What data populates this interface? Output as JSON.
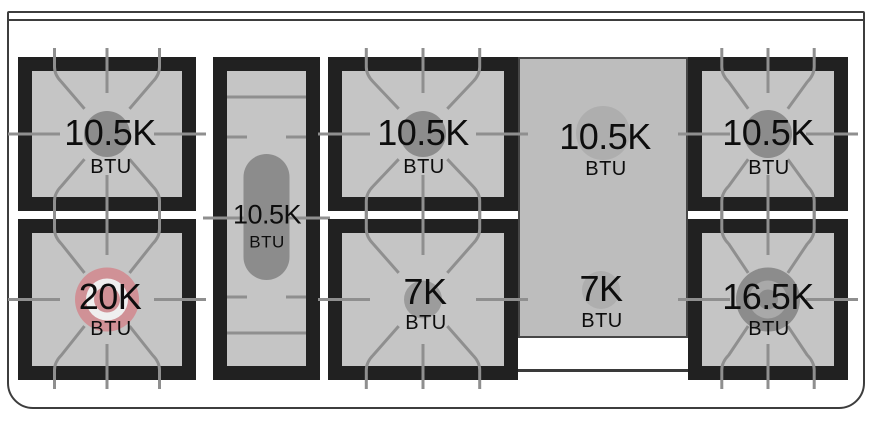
{
  "diagram": {
    "kind": "gas-range-cooktop-burner-layout",
    "unit": "BTU",
    "burners": [
      {
        "id": "left-rear",
        "location": "left module, rear",
        "label": "10.5K",
        "unit": "BTU",
        "value_btu": 10500,
        "style": "standard"
      },
      {
        "id": "left-front",
        "location": "left module, front",
        "label": "20K",
        "unit": "BTU",
        "value_btu": 20000,
        "style": "dual-ring-highlighted"
      },
      {
        "id": "center-oval",
        "location": "narrow center column, oval burner",
        "label": "10.5K",
        "unit": "BTU",
        "value_btu": 10500,
        "style": "oval"
      },
      {
        "id": "center-rear",
        "location": "center module, rear",
        "label": "10.5K",
        "unit": "BTU",
        "value_btu": 10500,
        "style": "standard"
      },
      {
        "id": "center-front",
        "location": "center module, front",
        "label": "7K",
        "unit": "BTU",
        "value_btu": 7000,
        "style": "standard-small"
      },
      {
        "id": "griddle-rear",
        "location": "under griddle plate, rear",
        "label": "10.5K",
        "unit": "BTU",
        "value_btu": 10500,
        "style": "under-plate"
      },
      {
        "id": "griddle-front",
        "location": "under griddle plate, front",
        "label": "7K",
        "unit": "BTU",
        "value_btu": 7000,
        "style": "under-plate"
      },
      {
        "id": "right-rear",
        "location": "right module, rear",
        "label": "10.5K",
        "unit": "BTU",
        "value_btu": 10500,
        "style": "standard"
      },
      {
        "id": "right-front",
        "location": "right module, front",
        "label": "16.5K",
        "unit": "BTU",
        "value_btu": 16500,
        "style": "dual-ring-gray"
      }
    ],
    "colors": {
      "module_black": "#212121",
      "surface_gray": "#c5c5c5",
      "grate_line": "#8f8f8f",
      "burner_standard": "#8c8c8c",
      "burner_small": "#9c9c9c",
      "burner_highlight_pink": "#d09196",
      "burner_ring_white": "#efefef",
      "burner_ring_gray": "#a9a9a9",
      "griddle_plate": "#bdbdbd",
      "griddle_burner": "#aeaeae",
      "frame_line": "#3d3d3d",
      "text": "#0d0d0d"
    }
  }
}
